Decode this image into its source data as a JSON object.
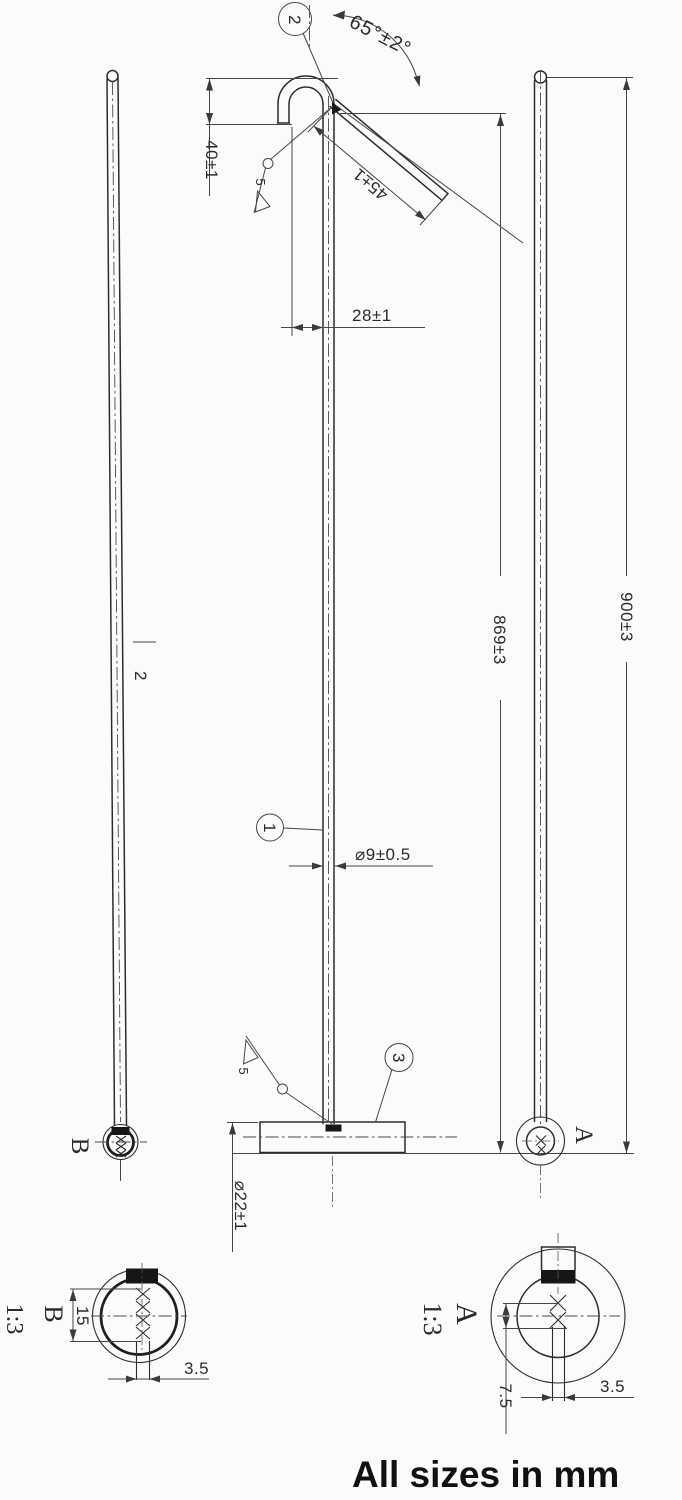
{
  "drawing": {
    "units_note": "All sizes in mm",
    "callouts": {
      "item1": "1",
      "item2": "2",
      "item3": "3"
    },
    "main_view": {
      "angle": "65°±2°",
      "arm_length": "45±1",
      "hook_height": "40±1",
      "hook_offset": "28±1",
      "rod_diameter": "⌀9±0.5",
      "overall_length": "869±3",
      "base_diameter": "⌀22±1",
      "weld_size_top": "5",
      "weld_size_bottom": "5"
    },
    "left_view": {
      "part_ref": "2",
      "section_label": "B"
    },
    "right_view": {
      "overall_length": "900±3",
      "section_label": "A"
    },
    "detail_b": {
      "label": "B",
      "scale": "1:3",
      "knurl_length": "15",
      "slot_width": "3.5"
    },
    "detail_a": {
      "label": "A",
      "scale": "1:3",
      "pin_offset": "7.5",
      "slot_width": "3.5"
    }
  }
}
